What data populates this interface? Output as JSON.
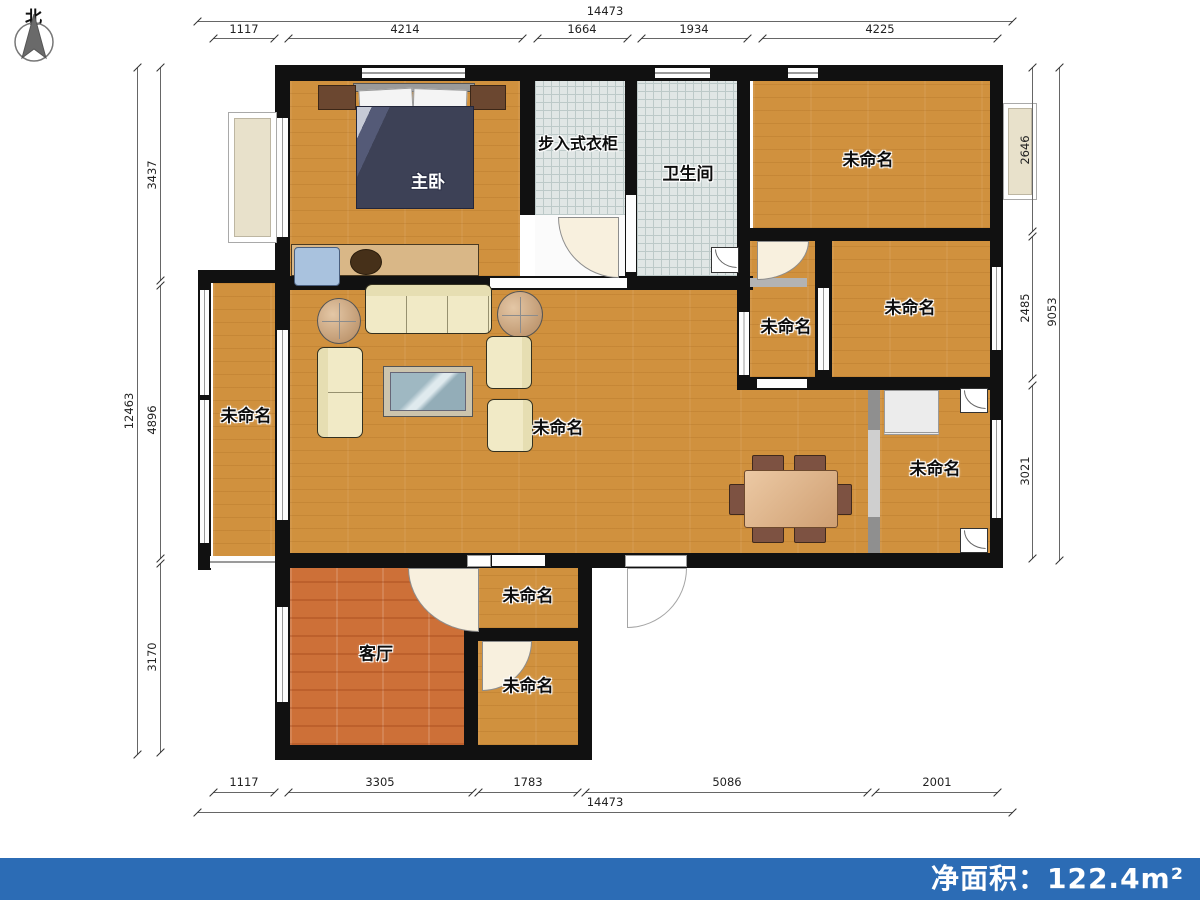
{
  "north_label": "北",
  "rooms": {
    "master_bedroom": "主卧",
    "walk_in_closet": "步入式衣柜",
    "bathroom": "卫生间",
    "living_room": "客厅",
    "unnamed": "未命名"
  },
  "dimensions": {
    "top": {
      "total": "14473",
      "segments": [
        "1117",
        "4214",
        "1664",
        "1934",
        "4225"
      ]
    },
    "bottom": {
      "total": "14473",
      "segments": [
        "1117",
        "3305",
        "1783",
        "5086",
        "2001"
      ]
    },
    "left": {
      "total": "12463",
      "segments": [
        "3437",
        "4896",
        "3170"
      ]
    },
    "right": {
      "total": "9053",
      "segments": [
        "2646",
        "2485",
        "3021"
      ]
    }
  },
  "footer": {
    "net_area": "净面积：122.4m²"
  },
  "colors": {
    "wall": "#111111",
    "wood_floor": "#d0913e",
    "living_floor": "#cd7038",
    "tile_floor": "#e0e6e5",
    "footer_bar": "#2c6cb5",
    "duvet": "#3d4156",
    "sofa": "#f1eac6"
  }
}
